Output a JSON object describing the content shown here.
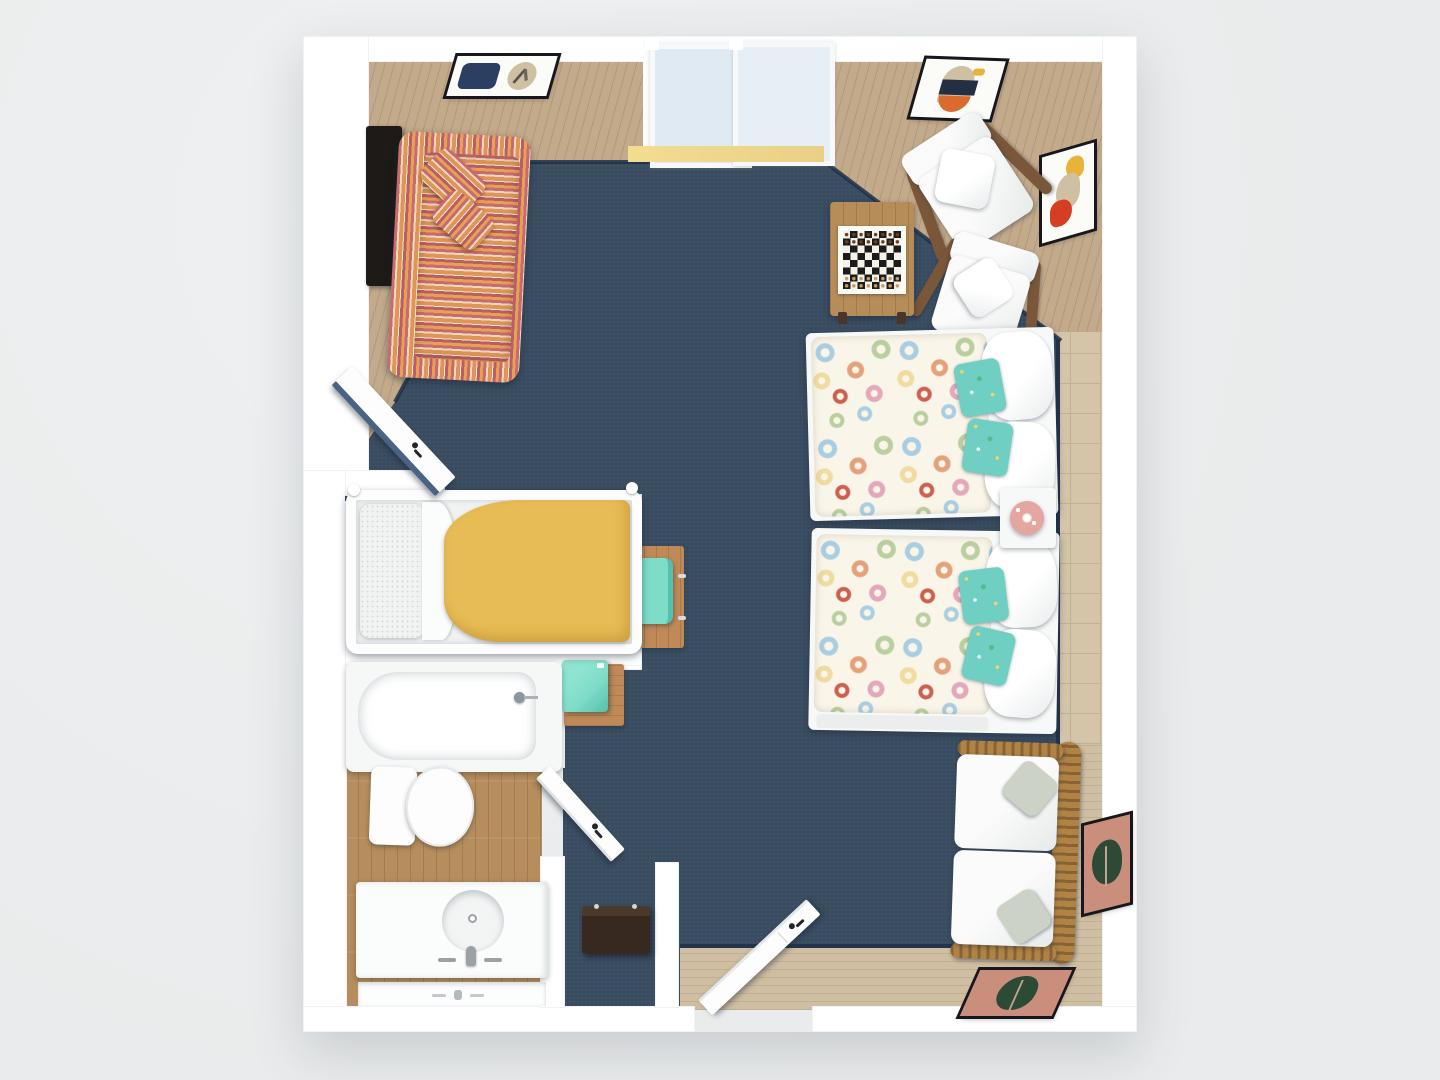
{
  "scene": {
    "title": "3D rendered top-down floor plan of a studio hotel suite",
    "view": "top-down 3d render",
    "visible_text": "none",
    "background_color": "#e9ebec"
  },
  "palette": {
    "bg": "#e9ebec",
    "wall": "#ffffff",
    "wall_shade": "#eef1f2",
    "carpet": "#394c60",
    "carpet_trim": "#1e3049",
    "wood_light": "#c3aa8a",
    "wood_line": "#b19877",
    "wood_right": "#cfbea2",
    "wood_right_line": "#bcab8e",
    "tile": "#d4c5a9",
    "tile_grout": "#c1b193",
    "wood_bath": "#b68d5c",
    "wood_bath_line": "#a37c4c",
    "accent_yellow": "#eed88d",
    "glass": "#dfeaf3",
    "glass_frame": "#f6f8fa",
    "teal": "#7eddc8",
    "teal_dark": "#56c0ae",
    "desk_wood": "#c08a58",
    "table_wood": "#b68c58",
    "frame_wood": "#7b573a",
    "stripe_a": "#c96a73",
    "stripe_b": "#e09556",
    "stripe_c": "#ead9bc",
    "stripe_d": "#b95d68",
    "blanket_yellow": "#e8bc55",
    "duvet_base": "#faf5e9",
    "white_f": "#f7f8f8",
    "sage": "#ccd2c5",
    "bench_brown": "#37291f",
    "terracotta": "#c98f7c",
    "plant_green": "#2c4a35",
    "art_navy": "#2b3f63",
    "art_beige": "#cfc0a4",
    "art_orange": "#d96b2f",
    "art_yellow": "#e8b33a",
    "lamp_coral": "#e4a69e",
    "tv_black": "#1d1a18",
    "chrome": "#9aa2a6",
    "checker_dark": "#1c1c1c",
    "checker_light": "#f5f2ea",
    "door_navy": "#4a6384"
  },
  "architecture": {
    "rooms": [
      {
        "name": "main-suite",
        "floor": "navy carpet with dark bound edge"
      },
      {
        "name": "living-corner",
        "floor": "light wood plank"
      },
      {
        "name": "sleeping-nook",
        "floor": "light wood plank"
      },
      {
        "name": "bathroom",
        "floor": "medium wood plank tile"
      },
      {
        "name": "entry-hall",
        "floor": "navy carpet with wood threshold"
      }
    ],
    "openings": [
      {
        "name": "sliding-glass-door",
        "wall": "top",
        "panels": 2,
        "glass": true
      },
      {
        "name": "nook-door",
        "state": "open",
        "swing": "into main room"
      },
      {
        "name": "bathroom-door",
        "state": "open",
        "swing": "into hall"
      },
      {
        "name": "entry-door",
        "state": "open",
        "wall": "bottom",
        "swing": "inward"
      }
    ]
  },
  "furniture": [
    {
      "id": "wall-tv",
      "label": "Wall-mounted TV",
      "room": "living-corner"
    },
    {
      "id": "striped-sofa",
      "label": "Multicolor striped sofa with two lumbar pillows",
      "room": "living-corner"
    },
    {
      "id": "artwork-navy-leaf",
      "label": "Framed abstract art (navy block + leaf)",
      "wall": "top"
    },
    {
      "id": "artwork-arch",
      "label": "Framed abstract art (arch, navy, orange)",
      "wall": "top-right"
    },
    {
      "id": "artwork-red-yellow",
      "label": "Framed abstract art (yellow, tan, red)",
      "wall": "right"
    },
    {
      "id": "lounge-chair-1",
      "label": "Wood-frame lounge chair with white cushion and pillow"
    },
    {
      "id": "lounge-chair-2",
      "label": "Wood-frame lounge chair with white cushion and pillow"
    },
    {
      "id": "game-table",
      "label": "Wooden game table with chessboard and pieces"
    },
    {
      "id": "guest-bed-1",
      "label": "Bed with seashell-print duvet, white and teal floral pillows"
    },
    {
      "id": "guest-bed-2",
      "label": "Bed with seashell-print duvet, white and teal floral pillows"
    },
    {
      "id": "nightstand",
      "label": "White nightstand",
      "accessory": "coral patterned table lamp"
    },
    {
      "id": "slat-bench-sofa",
      "label": "Wood slat-back settee with white cushions and sage pillows"
    },
    {
      "id": "artwork-botanical-right",
      "label": "Framed botanical art (terracotta + dark green)",
      "wall": "right"
    },
    {
      "id": "artwork-botanical-bottom",
      "label": "Framed botanical art (terracotta + dark green)",
      "wall": "bottom"
    },
    {
      "id": "desk",
      "label": "Wood desk with drawer pulls",
      "accessory": "teal desk chair"
    },
    {
      "id": "fridge-stand",
      "label": "Wood stand with teal mini fridge"
    },
    {
      "id": "daybed-yellow",
      "label": "Twin daybed with mustard-yellow blanket and white pillow",
      "room": "sleeping-nook"
    },
    {
      "id": "bathtub",
      "label": "Bathtub with shower head",
      "room": "bathroom"
    },
    {
      "id": "toilet",
      "label": "Toilet",
      "room": "bathroom"
    },
    {
      "id": "vanity-sink",
      "label": "Vanity counter with round sink, chrome faucet and mirror",
      "room": "bathroom"
    },
    {
      "id": "luggage-bench",
      "label": "Dark brown luggage bench",
      "room": "entry-hall"
    }
  ]
}
